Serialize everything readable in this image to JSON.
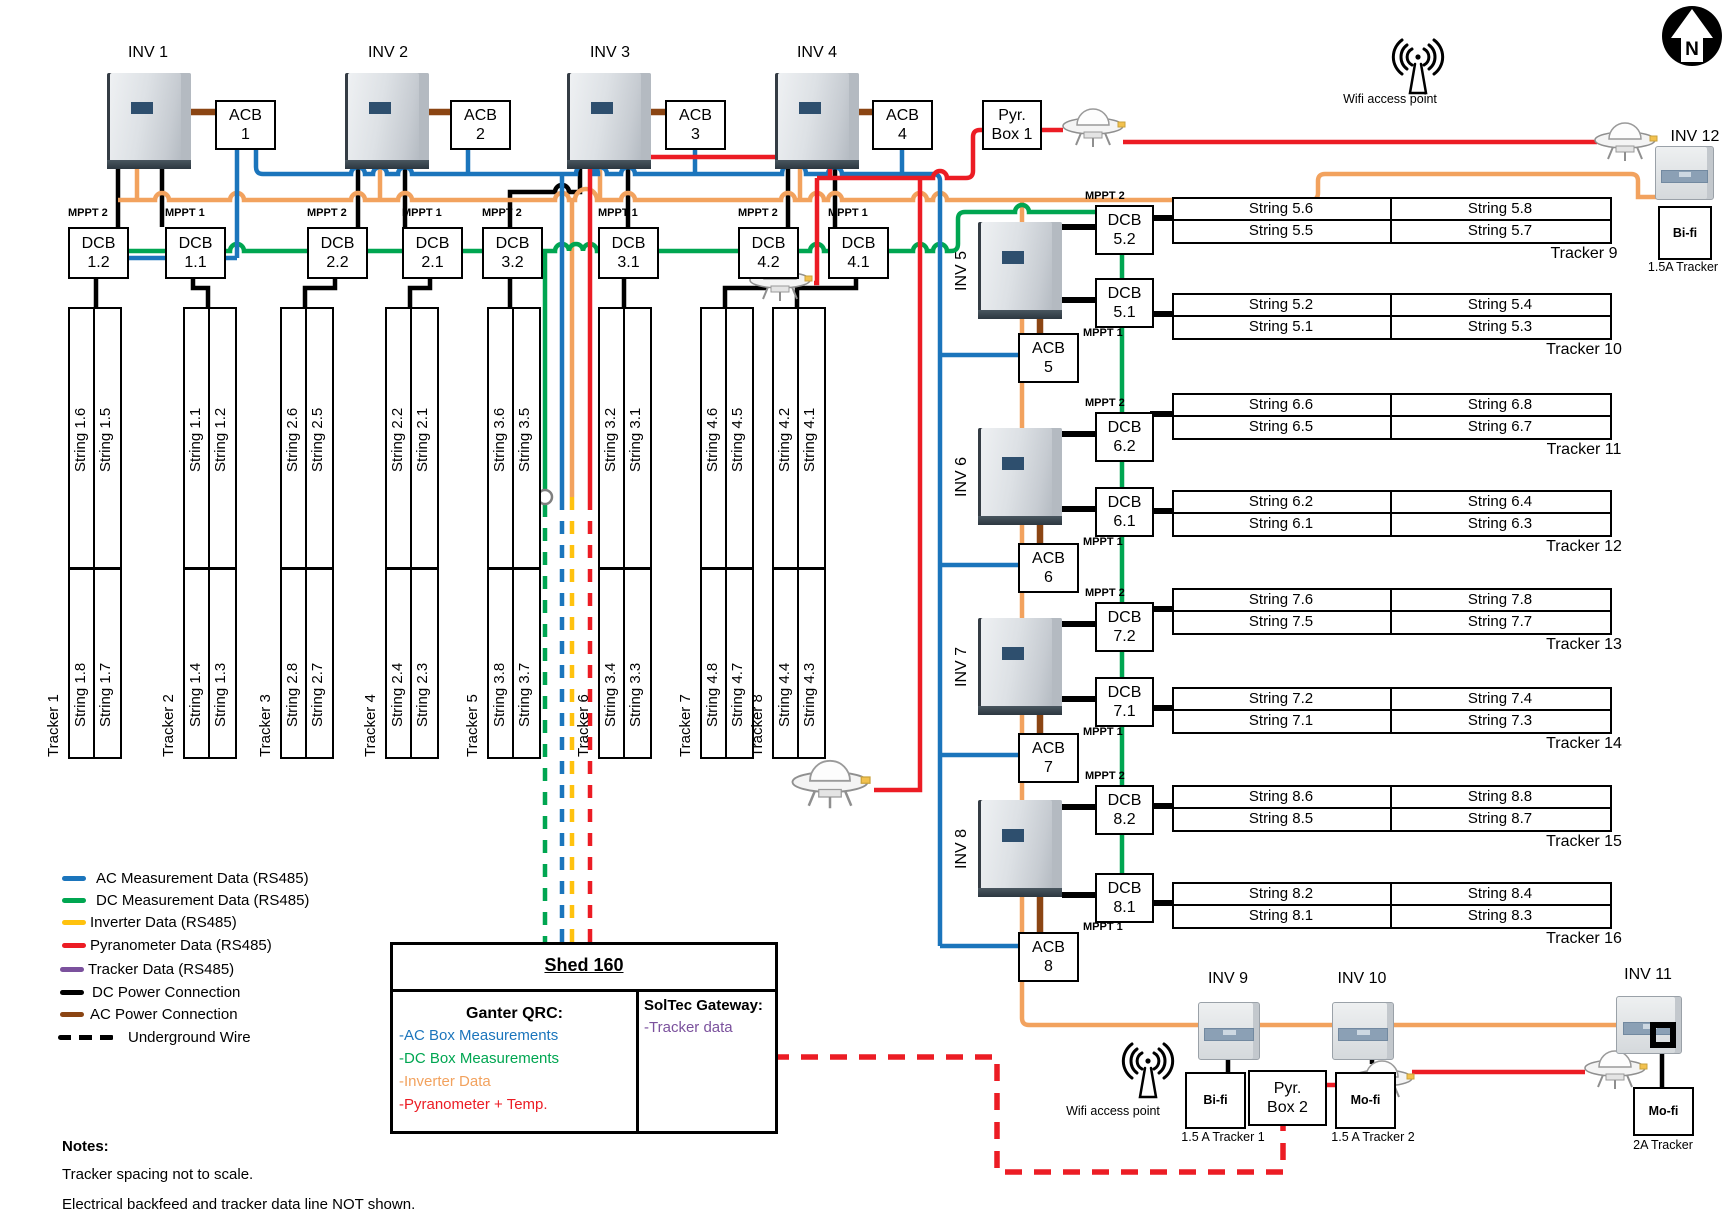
{
  "labels": {
    "dcb": "DCB",
    "acb": "ACB"
  },
  "north_label": "N",
  "wifi_label": "Wifi access point",
  "top_section": {
    "inverters": [
      "INV 1",
      "INV 2",
      "INV 3",
      "INV 4"
    ],
    "acbs": [
      "1",
      "2",
      "3",
      "4"
    ],
    "pyr_box": [
      "Pyr.",
      "Box 1"
    ],
    "dcbs": [
      {
        "mppt": "MPPT 2",
        "num": "1.2"
      },
      {
        "mppt": "MPPT 1",
        "num": "1.1"
      },
      {
        "mppt": "MPPT 2",
        "num": "2.2"
      },
      {
        "mppt": "MPPT 1",
        "num": "2.1"
      },
      {
        "mppt": "MPPT 2",
        "num": "3.2"
      },
      {
        "mppt": "MPPT 1",
        "num": "3.1"
      },
      {
        "mppt": "MPPT 2",
        "num": "4.2"
      },
      {
        "mppt": "MPPT 1",
        "num": "4.1"
      }
    ]
  },
  "trackers": [
    {
      "name": "Tracker 1",
      "top": [
        "String 1.6",
        "String 1.5"
      ],
      "bottom": [
        "String 1.8",
        "String 1.7"
      ]
    },
    {
      "name": "Tracker 2",
      "top": [
        "String 1.1",
        "String 1.2"
      ],
      "bottom": [
        "String 1.4",
        "String 1.3"
      ]
    },
    {
      "name": "Tracker 3",
      "top": [
        "String 2.6",
        "String 2.5"
      ],
      "bottom": [
        "String 2.8",
        "String 2.7"
      ]
    },
    {
      "name": "Tracker 4",
      "top": [
        "String 2.2",
        "String 2.1"
      ],
      "bottom": [
        "String 2.4",
        "String 2.3"
      ]
    },
    {
      "name": "Tracker 5",
      "top": [
        "String 3.6",
        "String 3.5"
      ],
      "bottom": [
        "String 3.8",
        "String 3.7"
      ]
    },
    {
      "name": "Tracker 6",
      "top": [
        "String 3.2",
        "String 3.1"
      ],
      "bottom": [
        "String 3.4",
        "String 3.3"
      ]
    },
    {
      "name": "Tracker 7",
      "top": [
        "String 4.6",
        "String 4.5"
      ],
      "bottom": [
        "String 4.8",
        "String 4.7"
      ]
    },
    {
      "name": "Tracker 8",
      "top": [
        "String 4.2",
        "String 4.1"
      ],
      "bottom": [
        "String 4.4",
        "String 4.3"
      ]
    }
  ],
  "right_section": {
    "units": [
      {
        "inv": "INV 5",
        "mppt2": "MPPT 2",
        "dcb2": "5.2",
        "mppt1": "MPPT 1",
        "dcb1": "5.1",
        "acb": "5"
      },
      {
        "inv": "INV 6",
        "mppt2": "MPPT 2",
        "dcb2": "6.2",
        "mppt1": "MPPT 1",
        "dcb1": "6.1",
        "acb": "6"
      },
      {
        "inv": "INV 7",
        "mppt2": "MPPT 2",
        "dcb2": "7.2",
        "mppt1": "MPPT 1",
        "dcb1": "7.1",
        "acb": "7"
      },
      {
        "inv": "INV 8",
        "mppt2": "MPPT 2",
        "dcb2": "8.2",
        "mppt1": "MPPT 1",
        "dcb1": "8.1",
        "acb": "8"
      }
    ],
    "tables": [
      {
        "name": "Tracker 9",
        "r1c1": "String 5.6",
        "r1c2": "String 5.8",
        "r2c1": "String 5.5",
        "r2c2": "String 5.7"
      },
      {
        "name": "Tracker 10",
        "r1c1": "String 5.2",
        "r1c2": "String 5.4",
        "r2c1": "String 5.1",
        "r2c2": "String 5.3"
      },
      {
        "name": "Tracker 11",
        "r1c1": "String 6.6",
        "r1c2": "String 6.8",
        "r2c1": "String 6.5",
        "r2c2": "String 6.7"
      },
      {
        "name": "Tracker 12",
        "r1c1": "String 6.2",
        "r1c2": "String 6.4",
        "r2c1": "String 6.1",
        "r2c2": "String 6.3"
      },
      {
        "name": "Tracker 13",
        "r1c1": "String 7.6",
        "r1c2": "String 7.8",
        "r2c1": "String 7.5",
        "r2c2": "String 7.7"
      },
      {
        "name": "Tracker 14",
        "r1c1": "String 7.2",
        "r1c2": "String 7.4",
        "r2c1": "String 7.1",
        "r2c2": "String 7.3"
      },
      {
        "name": "Tracker 15",
        "r1c1": "String 8.6",
        "r1c2": "String 8.8",
        "r2c1": "String 8.5",
        "r2c2": "String 8.7"
      },
      {
        "name": "Tracker 16",
        "r1c1": "String 8.2",
        "r1c2": "String 8.4",
        "r2c1": "String 8.1",
        "r2c2": "String 8.3"
      }
    ]
  },
  "bottom_section": {
    "pyr_box2": [
      "Pyr.",
      "Box 2"
    ],
    "inverters": [
      {
        "label": "INV 9",
        "box": "Bi-fi",
        "sub": "1.5 A Tracker 1"
      },
      {
        "label": "INV 10",
        "box": "Mo-fi",
        "sub": "1.5 A Tracker 2"
      },
      {
        "label": "INV 11",
        "box": "Mo-fi",
        "sub": "2A Tracker"
      }
    ]
  },
  "inv12": {
    "label": "INV 12",
    "box": "Bi-fi",
    "sub": "1.5A Tracker"
  },
  "legend": {
    "items": [
      {
        "label": "AC Measurement Data (RS485)",
        "color": "#1B75BC",
        "style": "solid"
      },
      {
        "label": "DC Measurement Data (RS485)",
        "color": "#00A651",
        "style": "solid"
      },
      {
        "label": "Inverter Data (RS485)",
        "color": "#FFC20E",
        "style": "solid"
      },
      {
        "label": "Pyranometer Data (RS485)",
        "color": "#EC1C24",
        "style": "solid"
      },
      {
        "label": "Tracker Data (RS485)",
        "color": "#7B519D",
        "style": "solid"
      },
      {
        "label": "DC Power Connection",
        "color": "#000000",
        "style": "solid"
      },
      {
        "label": "AC Power Connection",
        "color": "#8B4513",
        "style": "solid"
      },
      {
        "label": "Underground Wire",
        "color": "#000000",
        "style": "dashed"
      }
    ]
  },
  "shed": {
    "title": "Shed 160",
    "ganter_title": "Ganter QRC:",
    "ganter_items": [
      {
        "text": "-AC Box Measurements",
        "color": "#1B75BC"
      },
      {
        "text": "-DC Box Measurements",
        "color": "#00A651"
      },
      {
        "text": "-Inverter Data",
        "color": "#F2A25E"
      },
      {
        "text": "-Pyranometer + Temp.",
        "color": "#EC1C24"
      }
    ],
    "soltec_title": "SolTec Gateway:",
    "soltec_items": [
      {
        "text": "-Tracker data",
        "color": "#7B519D"
      }
    ]
  },
  "notes": {
    "heading": "Notes:",
    "lines": [
      "Tracker spacing not to scale.",
      "Electrical backfeed and tracker data line NOT shown."
    ]
  },
  "wire_colors": {
    "ac_measurement": "#1B75BC",
    "dc_measurement": "#00A651",
    "inverter_data_bus": "#F2A25E",
    "inverter_data_legend": "#FFC20E",
    "pyranometer": "#EC1C24",
    "tracker": "#7B519D",
    "dc_power": "#000000",
    "ac_power": "#8B4513"
  }
}
